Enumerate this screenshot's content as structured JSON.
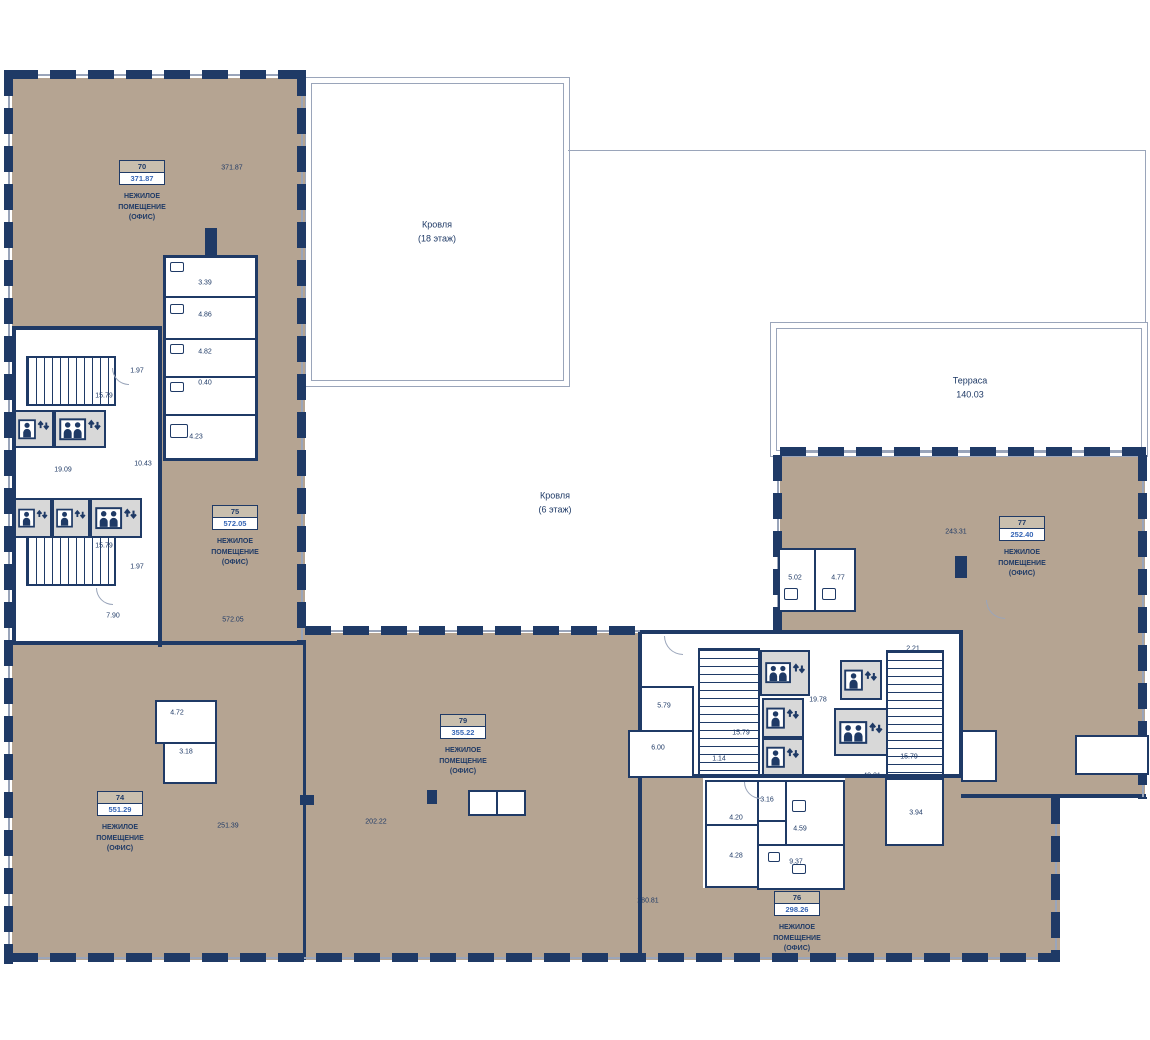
{
  "palette": {
    "wall_navy": "#1f3a66",
    "floor_beige": "#b5a492",
    "area_value_blue": "#3565b5",
    "thin_line": "#9aa5ba",
    "elevator_bg": "#d8d8d8"
  },
  "type_label": "НЕЖИЛОЕ\nПОМЕЩЕНИЕ\n(ОФИС)",
  "zones": {
    "roof18": "Кровля\n(18 этаж)",
    "roof6": "Кровля\n(6 этаж)",
    "terrace": "Терраса\n140.03"
  },
  "rooms": {
    "r70": {
      "number": "70",
      "area": "371.87"
    },
    "r74": {
      "number": "74",
      "area": "551.29"
    },
    "r75": {
      "number": "75",
      "area": "572.05"
    },
    "r76": {
      "number": "76",
      "area": "298.26"
    },
    "r77": {
      "number": "77",
      "area": "252.40"
    },
    "r79": {
      "number": "79",
      "area": "355.22"
    }
  },
  "dims": {
    "a70": "371.87",
    "wc1": "3.39",
    "wc2": "4.86",
    "wc3": "4.82",
    "wc4": "0.40",
    "wc5": "4.23",
    "st1": "1.97",
    "st2": "15.79",
    "lobby": "19.09",
    "hall": "10.43",
    "st3": "15.79",
    "st4": "1.97",
    "hall2": "7.90",
    "a75": "572.05",
    "a74": "251.39",
    "a79": "202.22",
    "a76": "280.81",
    "sw1": "4.72",
    "sw2": "3.18",
    "c1": "5.79",
    "c2": "6.00",
    "c3": "15.79",
    "c4": "1.14",
    "c5": "19.78",
    "c6": "15.79",
    "c7": "40.21",
    "c8": "2.21",
    "wr1": "5.02",
    "wr2": "4.77",
    "a77": "243.31",
    "b1": "4.20",
    "b2": "3.16",
    "b3": "4.59",
    "b4": "4.28",
    "b5": "9.37",
    "b6": "3.94"
  }
}
